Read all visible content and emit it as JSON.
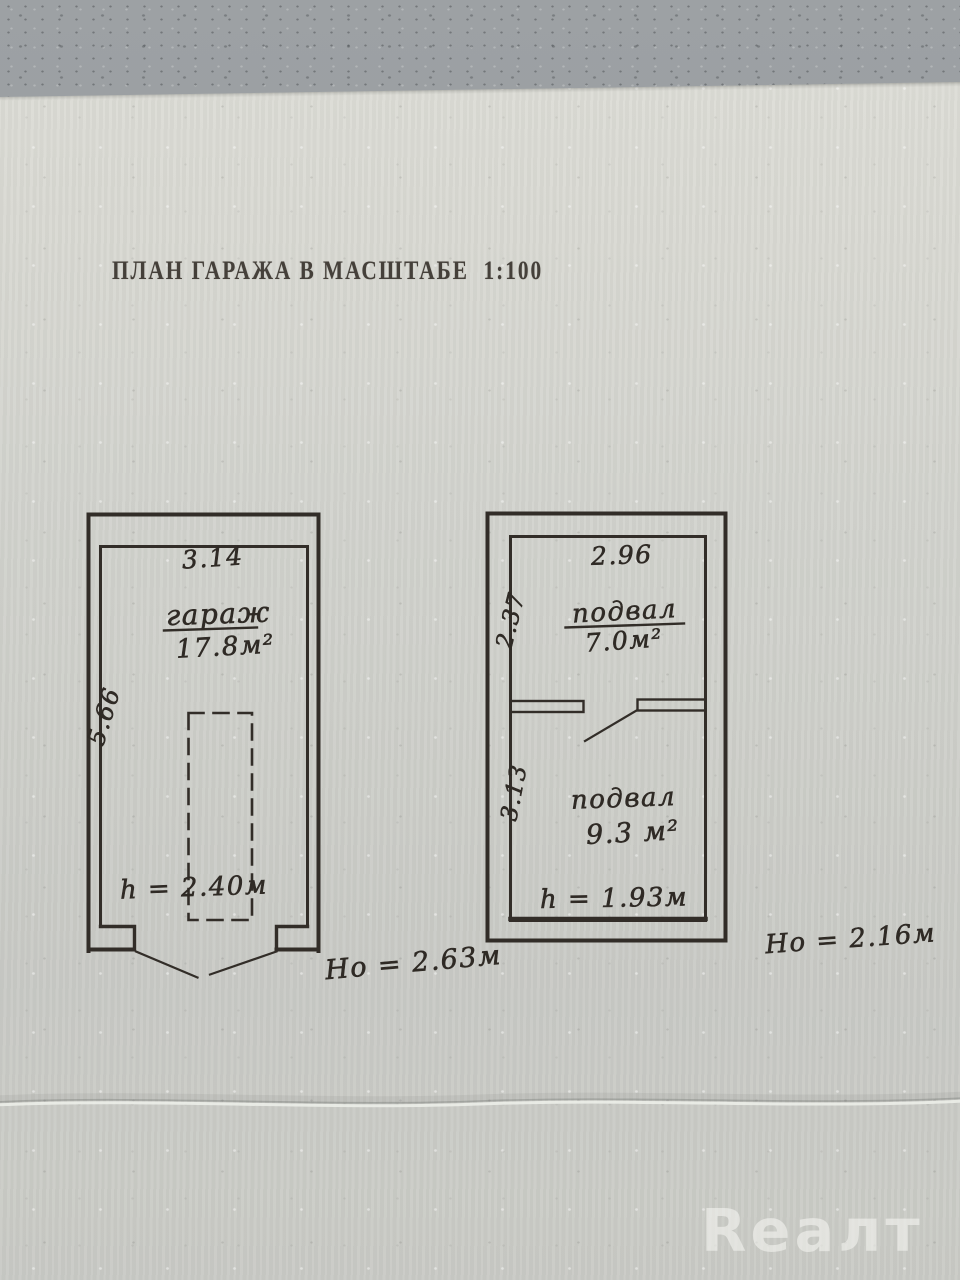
{
  "doc": {
    "title": "ПЛАН ГАРАЖА В МАСШТАБЕ  1:100",
    "watermark": "Reaлт"
  },
  "garage_plan": {
    "width": "3.14",
    "side": "5.66",
    "room_name": "гараж",
    "room_area": "17.8м²",
    "height_note": "h = 2.40м",
    "overall_height": "Но = 2.63м"
  },
  "basement_plan": {
    "width": "2.96",
    "room1_side": "2.37",
    "room1_name": "подвал",
    "room1_area": "7.0м²",
    "room2_side": "3.13",
    "room2_name": "подвал",
    "room2_area": "9.3 м²",
    "height_note": "h = 1.93м",
    "overall_height": "Но = 2.16м"
  }
}
